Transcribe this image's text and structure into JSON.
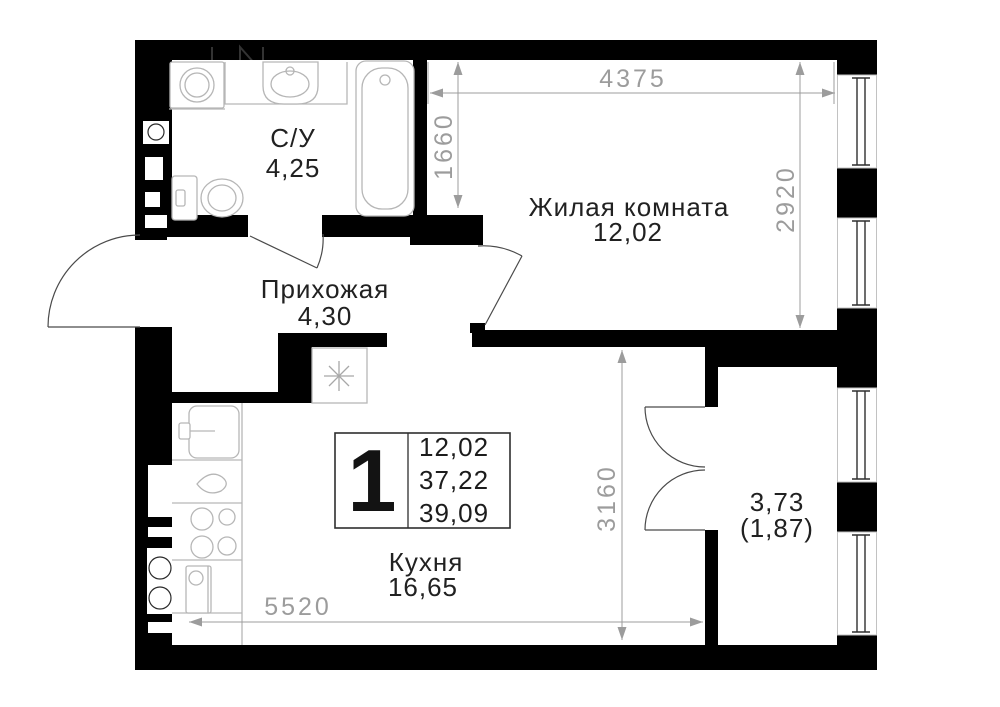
{
  "plan": {
    "rooms": {
      "bathroom": {
        "label": "С/У",
        "area": "4,25"
      },
      "living": {
        "label": "Жилая комната",
        "area": "12,02"
      },
      "hallway": {
        "label": "Прихожая",
        "area": "4,30"
      },
      "kitchen": {
        "label": "Кухня",
        "area": "16,65"
      },
      "balcony": {
        "area": "3,73",
        "area_reduced": "(1,87)"
      }
    },
    "unit_card": {
      "rooms_count": "1",
      "living_area": "12,02",
      "apartment_area": "37,22",
      "total_area": "39,09"
    },
    "dimensions_mm": {
      "living_width": "4375",
      "entry_side": "1660",
      "living_depth": "2920",
      "kitchen_depth": "3160",
      "kitchen_width": "5520"
    },
    "colors": {
      "wall": "#000000",
      "background": "#ffffff",
      "dimension": "#9c9c9c",
      "fixture_line": "#b6b6b6",
      "label_text": "#212121"
    }
  }
}
